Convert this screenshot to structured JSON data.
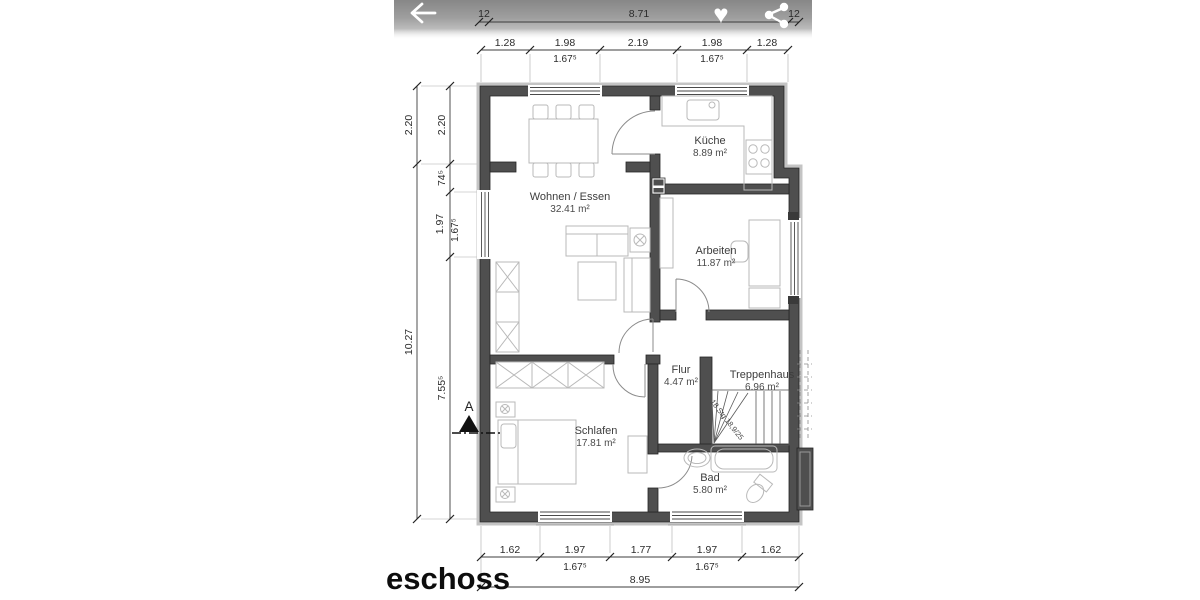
{
  "app": {
    "icons": {
      "back": "back-arrow",
      "heart_glyph": "♥",
      "share": "share-nodes"
    }
  },
  "plan": {
    "title_fragment": "eschoss",
    "section_marker": "A",
    "stair_note": "18 Stg 18,9/25",
    "rooms": [
      {
        "name": "Küche",
        "area": "8.89 m²"
      },
      {
        "name": "Wohnen / Essen",
        "area": "32.41 m²"
      },
      {
        "name": "Arbeiten",
        "area": "11.87 m²"
      },
      {
        "name": "Flur",
        "area": "4.47 m²"
      },
      {
        "name": "Treppenhaus",
        "area": "6.96 m²"
      },
      {
        "name": "Schlafen",
        "area": "17.81 m²"
      },
      {
        "name": "Bad",
        "area": "5.80 m²"
      }
    ],
    "dims": {
      "top_total": [
        "12",
        "8.71",
        "12"
      ],
      "top_segments": [
        "1.28",
        "1.98",
        "2.19",
        "1.98",
        "1.28"
      ],
      "top_window_dims": [
        "1.67⁵",
        "1.67⁵"
      ],
      "left_outer": [
        "2.20",
        "10.27"
      ],
      "left_inner": [
        "2.20",
        "74⁵",
        "1.97",
        "1.67⁵",
        "7.55⁵"
      ],
      "bottom_segments": [
        "1.62",
        "1.97",
        "1.77",
        "1.97",
        "1.62"
      ],
      "bottom_window_dims": [
        "1.67⁵",
        "1.67⁵"
      ],
      "bottom_total": "8.95"
    },
    "colors": {
      "wall": "#4f4f4f",
      "furniture_line": "#b9b9b9",
      "dim_line": "#3c3c3c",
      "topbar_icon": "#ffffff"
    }
  }
}
